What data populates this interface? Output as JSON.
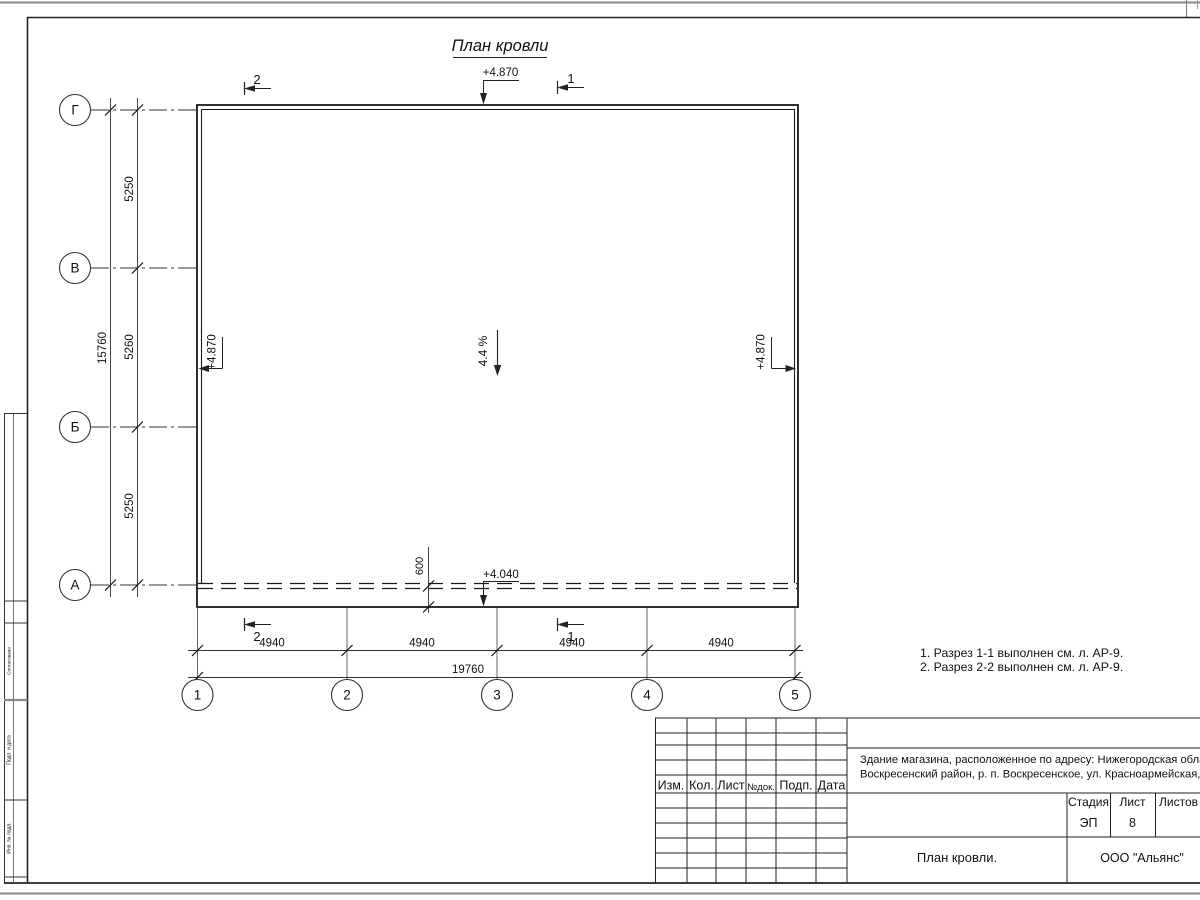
{
  "sheet": {
    "title": "План кровли"
  },
  "grid": {
    "rows": [
      "Г",
      "В",
      "Б",
      "А"
    ],
    "cols": [
      "1",
      "2",
      "3",
      "4",
      "5"
    ]
  },
  "dims": {
    "left_spans": [
      "5250",
      "5260",
      "5250"
    ],
    "left_total": "15760",
    "bottom_spans": [
      "4940",
      "4940",
      "4940",
      "4940"
    ],
    "bottom_total": "19760",
    "eave": "600"
  },
  "elevations": {
    "top": "+4.870",
    "left": "+4.870",
    "right": "+4.870",
    "eave": "+4.040"
  },
  "slope": "4.4 %",
  "sections": {
    "two": "2",
    "one": "1"
  },
  "notes": {
    "line1": "1. Разрез 1-1 выполнен см. л. АР-9.",
    "line2": "2. Разрез 2-2 выполнен см. л. АР-9."
  },
  "title_block": {
    "header_cells": [
      "Изм.",
      "Кол.",
      "Лист",
      "№док.",
      "Подп.",
      "Дата"
    ],
    "project_line1": "Здание магазина, расположенное по адресу: Нижегородская область,",
    "project_line2": "Воскресенский район, р. п. Воскресенское, ул. Красноармейская, д. 1",
    "stage_label": "Стадия",
    "sheet_label": "Лист",
    "sheets_label": "Листов",
    "stage": "ЭП",
    "sheet_no": "8",
    "drawing_name": "План кровли.",
    "company": "ООО \"Альянс\""
  },
  "side_stamp": {
    "cells": [
      "Согласовано",
      "Подп. и дата",
      "Инв. № подл."
    ]
  },
  "colors": {
    "line": "#222222",
    "paper_edge": "#919191"
  }
}
